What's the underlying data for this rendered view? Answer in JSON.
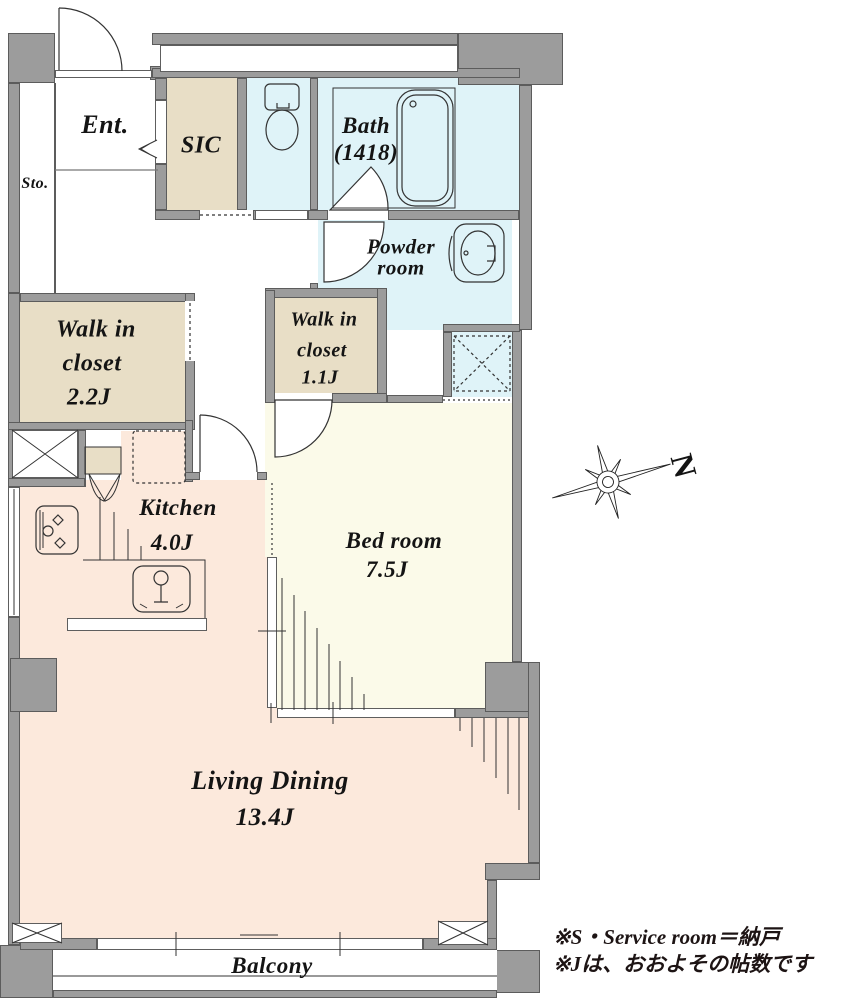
{
  "title": "Apartment floor plan",
  "rooms": {
    "entrance": {
      "label": "Ent."
    },
    "storage": {
      "label": "Sto."
    },
    "sic": {
      "label": "SIC"
    },
    "bath": {
      "line1": "Bath",
      "line2": "(1418)"
    },
    "powder": {
      "line1": "Powder",
      "line2": "room"
    },
    "wic_large": {
      "line1": "Walk in",
      "line2": "closet",
      "line3": "2.2J"
    },
    "wic_small": {
      "line1": "Walk in",
      "line2": "closet",
      "line3": "1.1J"
    },
    "kitchen": {
      "line1": "Kitchen",
      "line2": "4.0J"
    },
    "bedroom": {
      "line1": "Bed room",
      "line2": "7.5J"
    },
    "living_dining": {
      "line1": "Living Dining",
      "line2": "13.4J"
    },
    "balcony": {
      "label": "Balcony"
    }
  },
  "compass": {
    "label": "N"
  },
  "notes": {
    "line1": "※S・Service room＝納戸",
    "line2": "※Jは、おおよその帖数です"
  },
  "colors": {
    "wall": "#9c9c9c",
    "wall_edge": "#5c5c5c",
    "wet_area": "#dff3f8",
    "closet": "#e8dec6",
    "bedroom": "#fbfae9",
    "living": "#fce9dc",
    "line": "#333333"
  }
}
